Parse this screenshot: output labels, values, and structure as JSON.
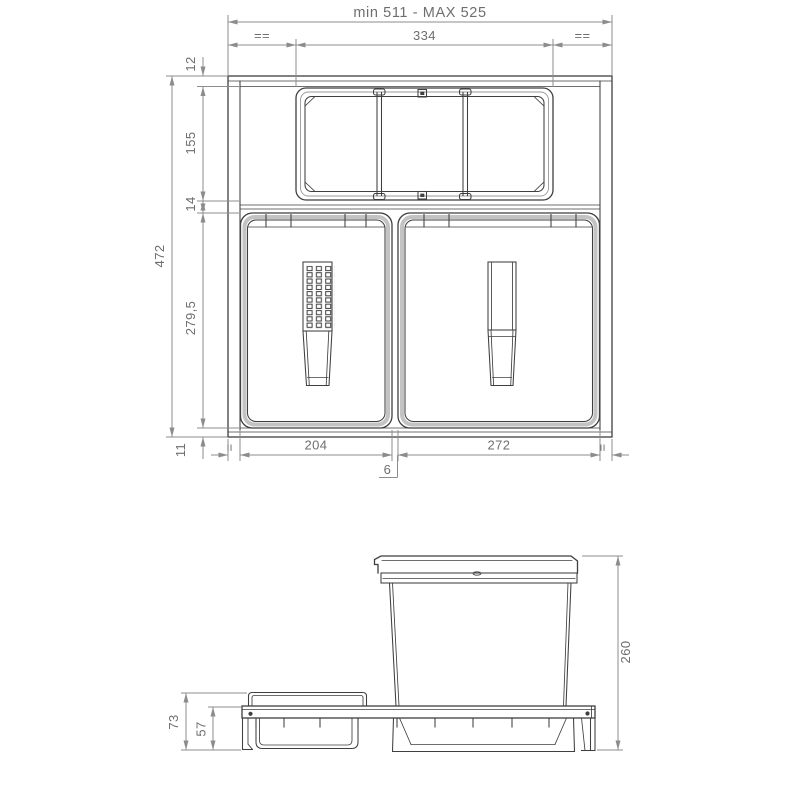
{
  "top_view": {
    "dims": {
      "overall_width": "min 511 - MAX 525",
      "equal_top_left": "==",
      "tray_width": "334",
      "equal_top_right": "==",
      "front_gap": "12",
      "tray_depth": "155",
      "middle_gap": "14",
      "overall_depth": "472",
      "bins_depth": "279,5",
      "rear_gap": "11",
      "equal_bottom_left": "=",
      "bin_left_width": "204",
      "bins_gap": "6",
      "bin_right_width": "272",
      "equal_bottom_right": "="
    }
  },
  "side_view": {
    "dims": {
      "bin_height": "260",
      "tray_unit_height": "73",
      "rail_height": "57"
    }
  }
}
